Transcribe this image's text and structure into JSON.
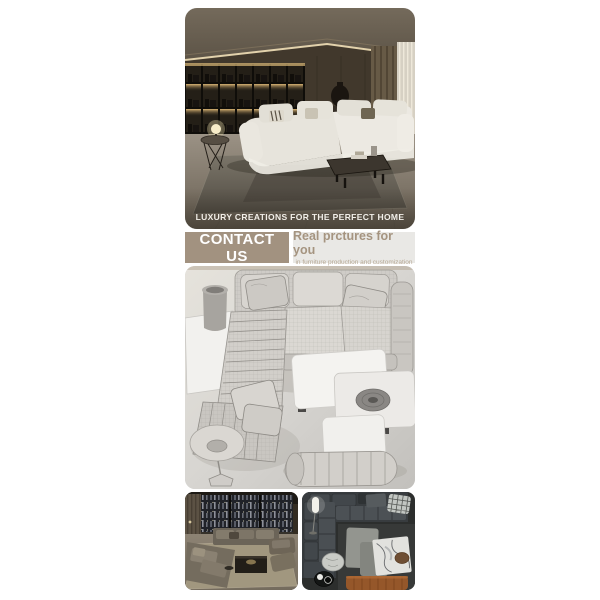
{
  "hero": {
    "caption": "LUXURY CREATIONS FOR THE PERFECT HOME"
  },
  "contact_bar": {
    "button_label": "CONTACT US",
    "tagline_title": "Real prctures for you",
    "tagline_subtitle": "in furniture production and customization"
  },
  "colors": {
    "accent_tan": "#a29280",
    "tagline_panel": "#e9e8e5",
    "tagline_text": "#a59480",
    "tagline_sub_text": "#b5a793",
    "caption_text": "#f2efe9",
    "render_bg_light": "#e4e2de",
    "render_bg_dark": "#c4c2be",
    "bench_orange": "#95572a"
  }
}
